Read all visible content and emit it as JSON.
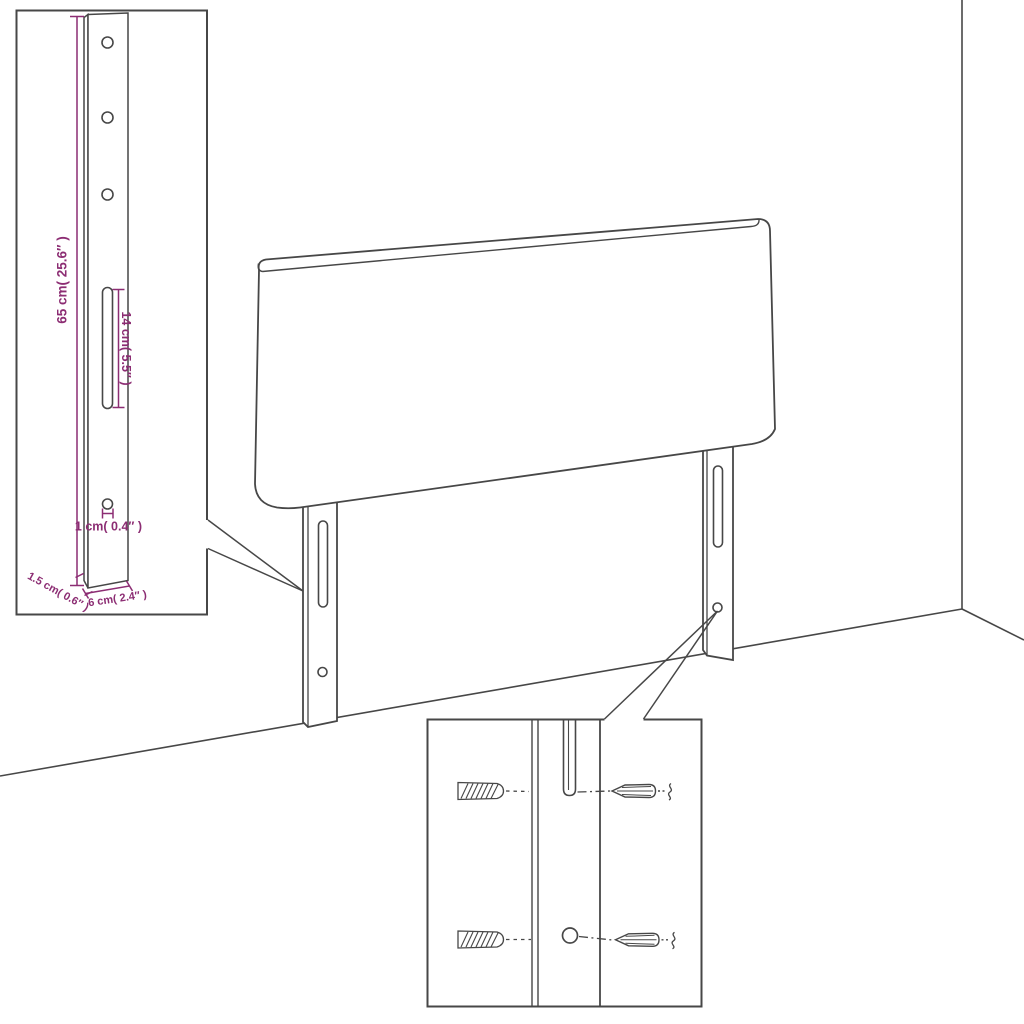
{
  "diagram_type": "furniture-assembly-dimension-diagram",
  "colors": {
    "line_art": "#474747",
    "dimension_annotation": "#8C2D73",
    "background": "#FFFFFF"
  },
  "labels": {
    "leg_height": "65 cm( 25.6″ )",
    "slot_length": "14 cm( 5.5″ )",
    "hole_diameter": "1 cm( 0.4″ )",
    "leg_thickness": "1.5 cm( 0.6″ )",
    "leg_width": "6 cm( 2.4″ )"
  }
}
